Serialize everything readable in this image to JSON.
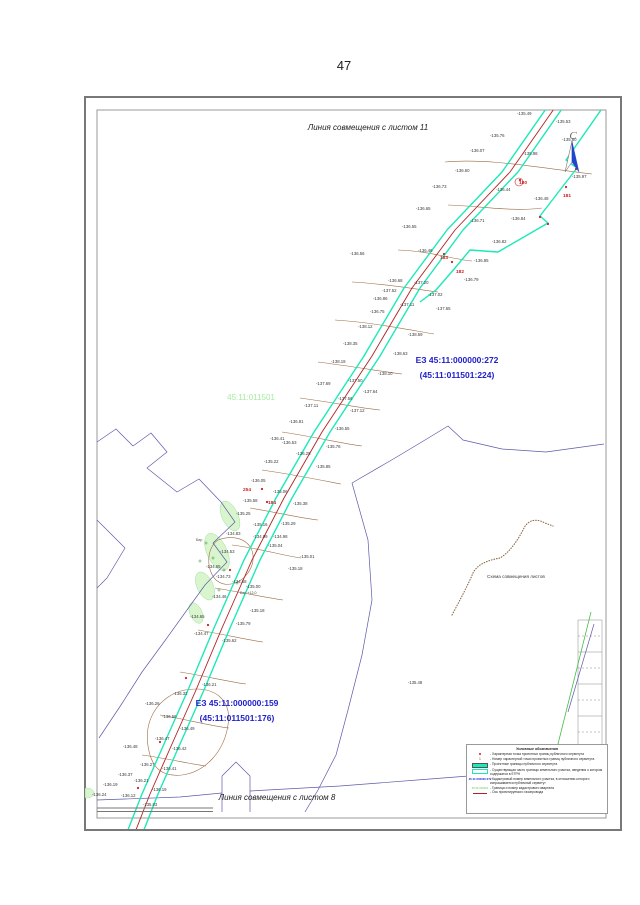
{
  "page": {
    "number": "47"
  },
  "colors": {
    "servitude_border": "#1de9b6",
    "axis_red": "#b22222",
    "cadastral_blue": "#5b5ba8",
    "parcel_label_blue": "#2020cc",
    "quarter_green": "#a5eda0",
    "contour_brown": "#9c6b42"
  },
  "map": {
    "top_edge_label": "Линия совмещения с листом 11",
    "bottom_edge_label": "Линия совмещения с листом 8",
    "scheme_label": "Схема совмещения листов",
    "north_label": "С",
    "quarter_label": {
      "text": "45:11:011501",
      "x": 251,
      "y": 400
    },
    "parcel_labels": [
      {
        "lines": [
          "ЕЗ 45:11:000000:272",
          "(45:11:011501:224)"
        ],
        "x": 457,
        "y": 363
      },
      {
        "lines": [
          "ЕЗ 45:11:000000:159",
          "(45:11:011501:176)"
        ],
        "x": 237,
        "y": 706
      }
    ],
    "spot_labels": [
      {
        "v": "-135.48",
        "x": 408,
        "y": 684
      },
      {
        "v": "-135.83",
        "x": 143,
        "y": 806
      }
    ],
    "tree_labels": [
      {
        "t": "Бер",
        "x": 196,
        "y": 541
      },
      {
        "t": "Бер +12,0",
        "x": 240,
        "y": 594
      }
    ],
    "point_numbers": [
      {
        "n": "180",
        "x": 519,
        "y": 184
      },
      {
        "n": "181",
        "x": 563,
        "y": 197
      },
      {
        "n": "182",
        "x": 456,
        "y": 273
      },
      {
        "n": "183",
        "x": 440,
        "y": 259
      },
      {
        "n": "184",
        "x": 268,
        "y": 504
      },
      {
        "n": "254",
        "x": 243,
        "y": 491
      }
    ],
    "elevations": [
      [
        517,
        115,
        "-135.49"
      ],
      [
        556,
        123,
        "-135.53"
      ],
      [
        490,
        137,
        "-135.76"
      ],
      [
        562,
        141,
        "-135.80"
      ],
      [
        523,
        155,
        "-135.98"
      ],
      [
        572,
        178,
        "-135.97"
      ],
      [
        470,
        152,
        "-136.07"
      ],
      [
        455,
        172,
        "-136.60"
      ],
      [
        534,
        200,
        "-136.48"
      ],
      [
        496,
        191,
        "-136.44"
      ],
      [
        432,
        188,
        "-136.73"
      ],
      [
        511,
        220,
        "-136.84"
      ],
      [
        470,
        222,
        "-136.71"
      ],
      [
        416,
        210,
        "-136.65"
      ],
      [
        492,
        243,
        "-136.82"
      ],
      [
        402,
        228,
        "-136.55"
      ],
      [
        474,
        262,
        "-136.85"
      ],
      [
        464,
        281,
        "-136.79"
      ],
      [
        418,
        252,
        "-136.46"
      ],
      [
        350,
        255,
        "-136.56"
      ],
      [
        388,
        282,
        "-136.68"
      ],
      [
        428,
        296,
        "-137.02"
      ],
      [
        373,
        300,
        "-136.86"
      ],
      [
        414,
        284,
        "-137.20"
      ],
      [
        382,
        292,
        "-137.52"
      ],
      [
        436,
        310,
        "-137.65"
      ],
      [
        370,
        313,
        "-136.75"
      ],
      [
        400,
        306,
        "-137.11"
      ],
      [
        358,
        328,
        "-138.12"
      ],
      [
        343,
        345,
        "-138.35"
      ],
      [
        408,
        336,
        "-138.59"
      ],
      [
        393,
        355,
        "-138.63"
      ],
      [
        331,
        363,
        "-138.19"
      ],
      [
        378,
        375,
        "-138.10"
      ],
      [
        316,
        385,
        "-137.69"
      ],
      [
        348,
        382,
        "-137.50"
      ],
      [
        363,
        393,
        "-137.64"
      ],
      [
        338,
        400,
        "-137.56"
      ],
      [
        350,
        412,
        "-137.12"
      ],
      [
        335,
        430,
        "-136.55"
      ],
      [
        304,
        407,
        "-137.11"
      ],
      [
        289,
        423,
        "-136.81"
      ],
      [
        270,
        440,
        "-136.41"
      ],
      [
        326,
        448,
        "-135.76"
      ],
      [
        296,
        455,
        "-136.25"
      ],
      [
        264,
        463,
        "-135.22"
      ],
      [
        316,
        468,
        "-135.85"
      ],
      [
        251,
        482,
        "-136.05"
      ],
      [
        273,
        493,
        "-135.06"
      ],
      [
        243,
        502,
        "-135.58"
      ],
      [
        293,
        505,
        "-135.38"
      ],
      [
        236,
        515,
        "-135.25"
      ],
      [
        281,
        525,
        "-135.29"
      ],
      [
        253,
        526,
        "-135.16"
      ],
      [
        273,
        538,
        "-134.98"
      ],
      [
        253,
        538,
        "-134.99"
      ],
      [
        268,
        547,
        "-135.04"
      ],
      [
        300,
        558,
        "-135.01"
      ],
      [
        288,
        570,
        "-135.18"
      ],
      [
        226,
        535,
        "-134.83"
      ],
      [
        220,
        553,
        "-134.53"
      ],
      [
        206,
        568,
        "-134.65"
      ],
      [
        216,
        578,
        "-134.73"
      ],
      [
        232,
        583,
        "-134.68"
      ],
      [
        212,
        598,
        "-134.46"
      ],
      [
        246,
        588,
        "-135.00"
      ],
      [
        250,
        612,
        "-135.18"
      ],
      [
        190,
        618,
        "-134.65"
      ],
      [
        194,
        635,
        "-134.47"
      ],
      [
        236,
        625,
        "-135.79"
      ],
      [
        222,
        642,
        "-135.62"
      ],
      [
        282,
        444,
        "-136.53"
      ],
      [
        202,
        686,
        "-136.21"
      ],
      [
        173,
        695,
        "-136.32"
      ],
      [
        145,
        705,
        "-136.26"
      ],
      [
        162,
        718,
        "-136.56"
      ],
      [
        180,
        730,
        "-136.49"
      ],
      [
        155,
        740,
        "-136.47"
      ],
      [
        172,
        750,
        "-136.42"
      ],
      [
        123,
        748,
        "-136.48"
      ],
      [
        162,
        770,
        "-136.41"
      ],
      [
        140,
        766,
        "-136.27"
      ],
      [
        118,
        776,
        "-136.37"
      ],
      [
        134,
        782,
        "-136.21"
      ],
      [
        103,
        786,
        "-136.19"
      ],
      [
        152,
        791,
        "-136.19"
      ],
      [
        92,
        796,
        "-136.24"
      ],
      [
        121,
        797,
        "-136.12"
      ]
    ],
    "geometry": {
      "route_center": "M556,106 L510,172 L455,230 L412,288 L372,356 L322,432 L284,498 L252,560 L222,628 L196,690 L172,744 L150,794 L132,840",
      "route_left": "M548,106 L502,172 L447,230 L404,288 L364,356 L314,432 L276,498 L244,560 L214,628 L188,690 L164,744 L142,794 L124,840",
      "route_right": "M564,106 L518,172 L463,230 L420,288 L380,356 L330,432 L292,498 L260,560 L230,628 L204,690 L180,744 L158,794 L140,840",
      "boundary_right": "M601,110 L566,160 L577,168 L540,216 L548,223 L498,252 L470,250 L455,268 L436,290 L420,302",
      "blue_paths": [
        "M97,442 L116,429 L133,446 L151,433 L167,452 L147,468 L177,492 L199,479 L221,502 L235,522 L213,543 L227,562 L205,585 L187,610 L164,642 L142,672 L121,705 L99,738",
        "M97,520 L125,548 L107,578 L97,588",
        "M97,800 L180,797 L222,793",
        "M222,812 L222,776 L236,762 L250,776 L250,812",
        "M250,791 L340,786 L430,779 L520,772 L575,766",
        "M352,483 L395,458 L430,437 L448,426 L463,440 L502,449 L546,452 L604,444",
        "M352,483 L368,540 L372,600 L362,655 L348,710 L336,755 L318,790 L305,812"
      ],
      "contour_paths": [
        "M445,162 C490,158 540,168 592,174",
        "M448,205 C480,206 515,212 542,208",
        "M398,250 C430,251 456,260 472,261",
        "M352,282 C390,284 420,290 438,292",
        "M335,320 C370,322 410,330 434,334",
        "M318,362 C350,366 385,372 402,374",
        "M300,398 C330,402 360,408 380,410",
        "M282,432 C310,436 345,444 362,446",
        "M262,470 C290,474 320,480 341,484",
        "M250,508 C275,512 300,518 318,520",
        "M232,545 C258,548 285,556 301,558",
        "M215,588 C240,592 268,598 283,600",
        "M198,630 C222,634 248,640 263,642",
        "M180,672 C205,676 230,682 246,684",
        "M160,715 C185,719 210,726 229,728",
        "M142,755 C165,758 190,764 206,766",
        "M150,755 C140,720 160,695 185,690 C215,685 232,700 228,725 C224,752 205,772 182,775 C162,777 154,768 150,755",
        "M218,540 C240,532 258,545 252,565 C246,582 228,590 216,580 C206,570 206,548 218,540"
      ],
      "gully_path": "M452,615 C460,600 468,585 473,573 C478,563 490,560 500,558 C510,552 518,540 524,528 C527,522 534,517 545,523 L553,526",
      "green_line": "M591,612 L556,752",
      "blue_line": "M594,624 L568,712",
      "patches": [
        [
          230,
          516,
          8,
          16,
          -25
        ],
        [
          217,
          552,
          10,
          20,
          -25
        ],
        [
          205,
          586,
          8,
          15,
          -25
        ],
        [
          196,
          613,
          6,
          11,
          -25
        ],
        [
          87,
          793,
          7,
          5,
          0
        ]
      ],
      "tree_circles": [
        [
          206,
          543
        ],
        [
          213,
          558
        ],
        [
          224,
          570
        ],
        [
          237,
          583
        ],
        [
          200,
          561
        ],
        [
          219,
          590
        ]
      ],
      "red_dots": [
        [
          520,
          180
        ],
        [
          566,
          187
        ],
        [
          576,
          169
        ],
        [
          540,
          217
        ],
        [
          548,
          224
        ],
        [
          452,
          262
        ],
        [
          444,
          254
        ],
        [
          262,
          489
        ],
        [
          267,
          502
        ],
        [
          230,
          570
        ],
        [
          208,
          625
        ],
        [
          186,
          678
        ],
        [
          160,
          742
        ],
        [
          138,
          788
        ]
      ],
      "sheet_grid": {
        "x1": 578,
        "x2": 602,
        "rows": [
          620,
          636,
          652,
          668,
          684,
          700,
          716,
          732,
          748
        ]
      },
      "scale_bar": {
        "x1": 97,
        "x2": 213,
        "y1": 808,
        "y2": 811.5
      }
    }
  },
  "legend": {
    "title": "Условные обозначения",
    "items": [
      {
        "sym": "dot",
        "label": "- Характерная точка проектных границ публичного сервитута"
      },
      {
        "sym": "num",
        "symtext": "1",
        "label": "- Номер характерной точки проектных границ публичного сервитута"
      },
      {
        "sym": "line-cyan",
        "label": "- Проектные границы публичного сервитута"
      },
      {
        "sym": "rect-cyan",
        "label": "- Существующая часть границы земельного участка, сведения о котором содержатся в ЕГРН"
      },
      {
        "sym": "text-blue",
        "symtext": "45:11:000000:272",
        "label": "- Кадастровый номер земельного участка, в отношении которого испрашивается публичный сервитут"
      },
      {
        "sym": "text-green",
        "symtext": "45:11:011501",
        "label": "- Граница и номер кадастрового квартала"
      },
      {
        "sym": "line-red",
        "label": "- Ось проектируемого газопровода"
      }
    ]
  }
}
